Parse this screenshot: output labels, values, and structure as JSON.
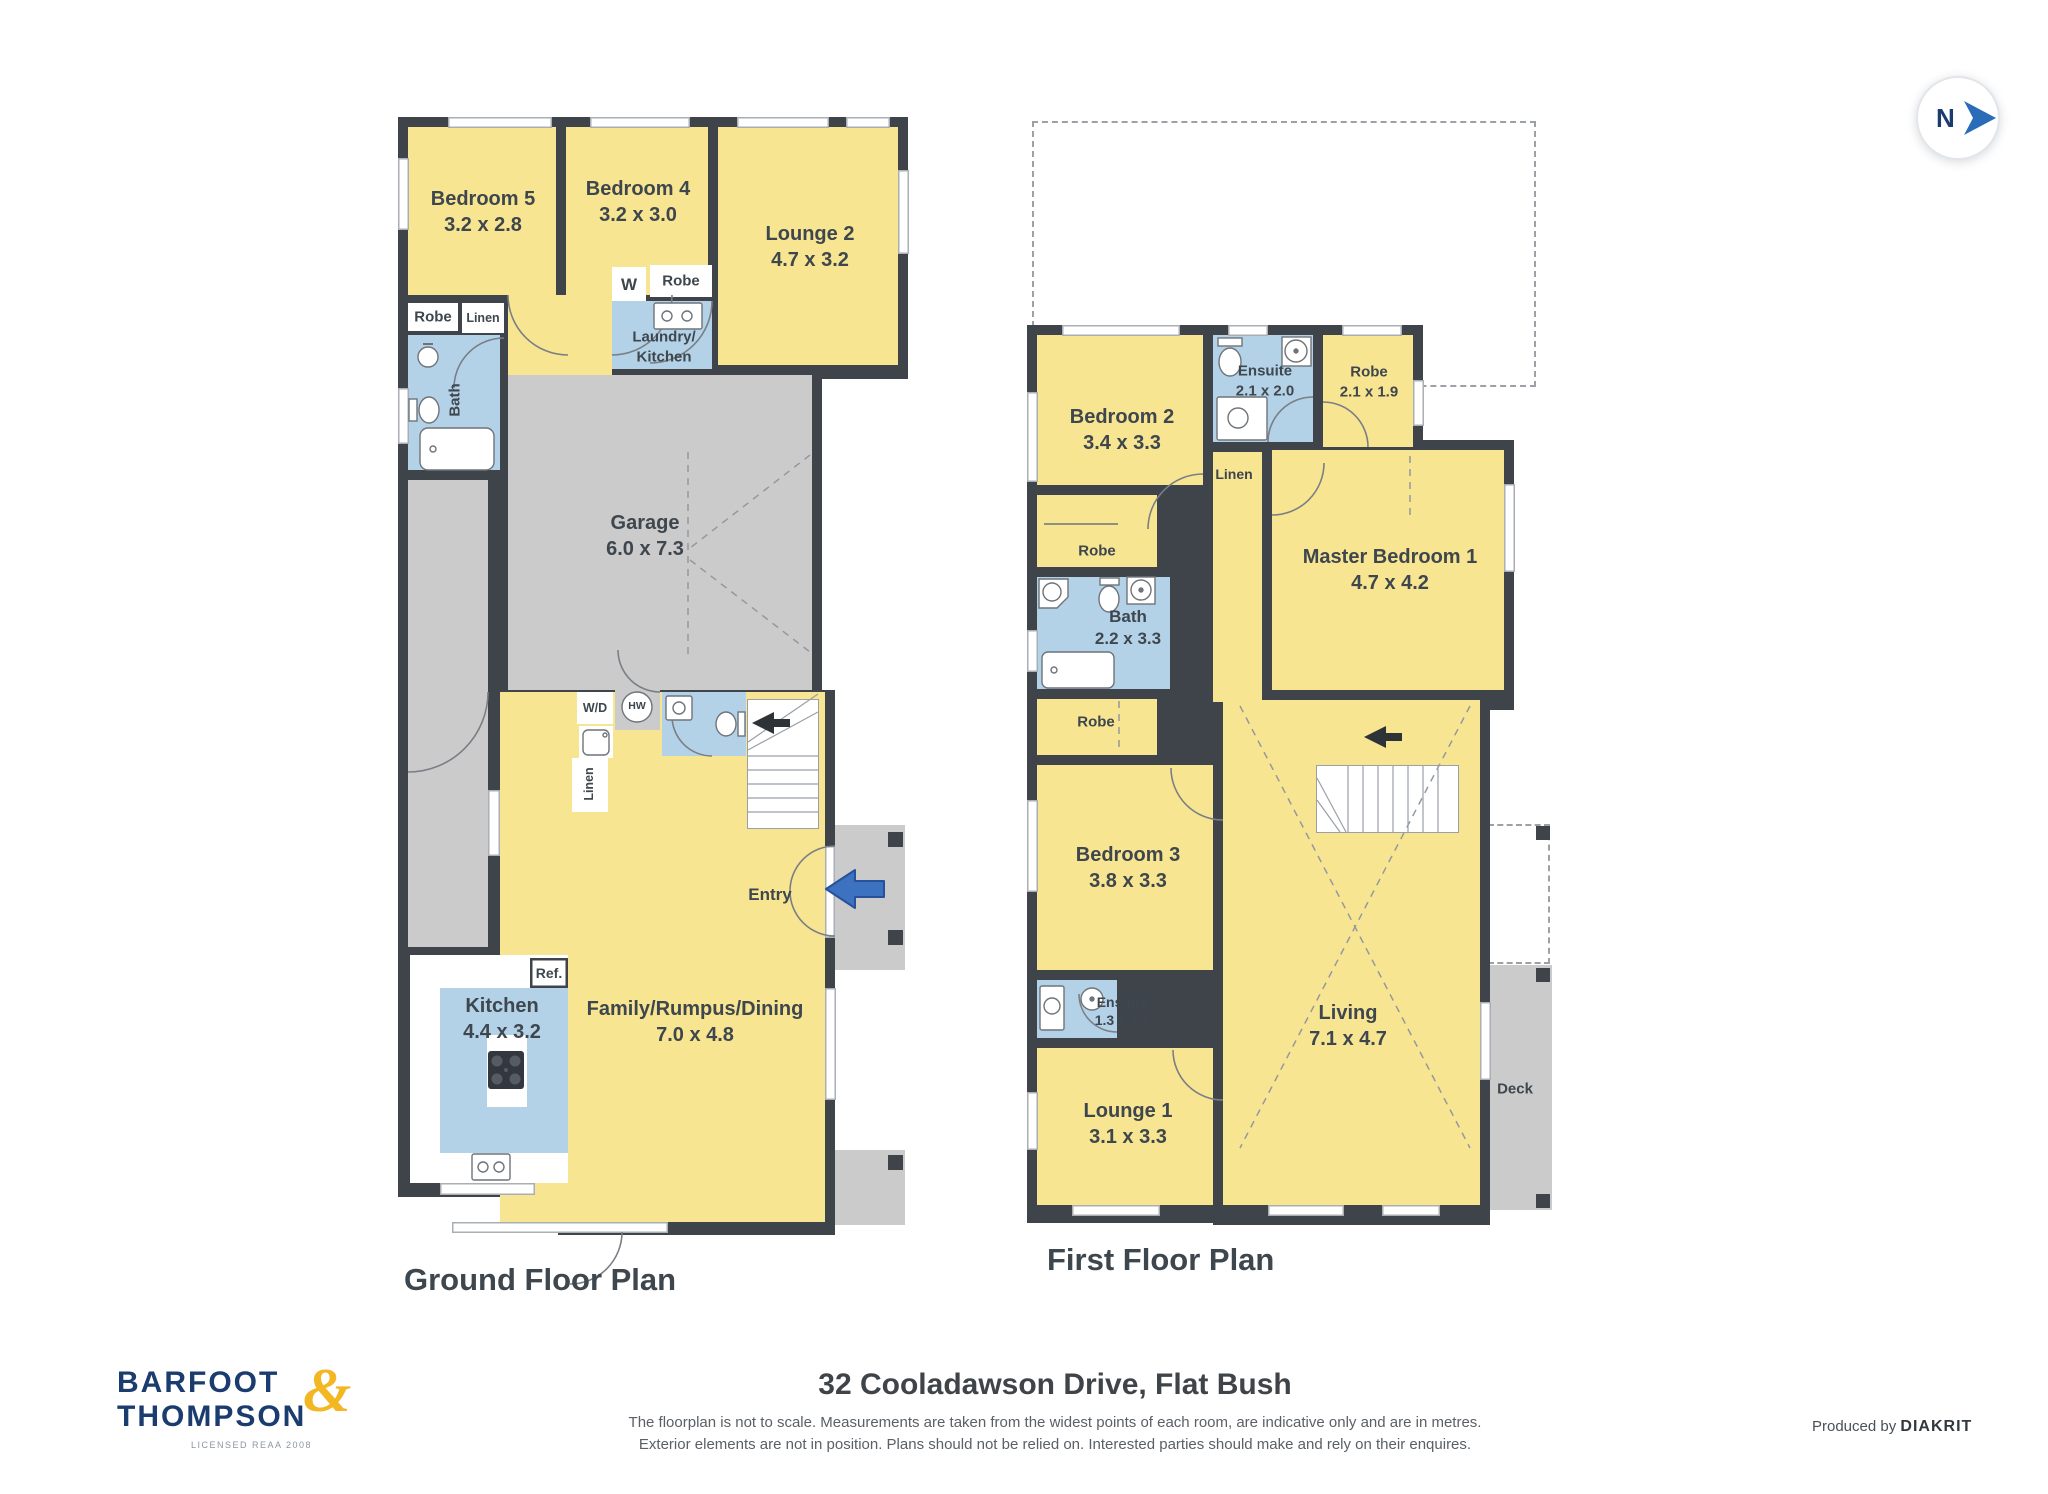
{
  "compass": {
    "n": "N"
  },
  "ground": {
    "title": "Ground Floor Plan",
    "rooms": {
      "bedroom5": {
        "name": "Bedroom 5",
        "dims": "3.2 x 2.8"
      },
      "bedroom4": {
        "name": "Bedroom 4",
        "dims": "3.2 x 3.0"
      },
      "lounge2": {
        "name": "Lounge 2",
        "dims": "4.7 x 3.2"
      },
      "robe1": {
        "name": "Robe"
      },
      "linen1": {
        "name": "Linen"
      },
      "bath": {
        "name": "Bath"
      },
      "w": {
        "name": "W"
      },
      "robe2": {
        "name": "Robe"
      },
      "laundry_line1": "Laundry/",
      "laundry_line2": "Kitchen",
      "garage": {
        "name": "Garage",
        "dims": "6.0 x 7.3"
      },
      "wd": {
        "name": "W/D"
      },
      "hw": {
        "name": "HW"
      },
      "linen2": {
        "name": "Linen"
      },
      "entry": {
        "name": "Entry"
      },
      "kitchen": {
        "name": "Kitchen",
        "dims": "4.4 x 3.2"
      },
      "ref": {
        "name": "Ref."
      },
      "family": {
        "name": "Family/Rumpus/Dining",
        "dims": "7.0 x 4.8"
      }
    }
  },
  "first": {
    "title": "First Floor Plan",
    "rooms": {
      "bedroom2": {
        "name": "Bedroom 2",
        "dims": "3.4 x 3.3"
      },
      "ensuite1": {
        "name": "Ensuite",
        "dims": "2.1 x 2.0"
      },
      "robe1": {
        "name": "Robe",
        "dims": "2.1 x 1.9"
      },
      "linen": {
        "name": "Linen"
      },
      "master": {
        "name": "Master Bedroom 1",
        "dims": "4.7 x 4.2"
      },
      "robe2": {
        "name": "Robe"
      },
      "bath": {
        "name": "Bath",
        "dims": "2.2 x 3.3"
      },
      "robe3": {
        "name": "Robe"
      },
      "bedroom3": {
        "name": "Bedroom 3",
        "dims": "3.8 x 3.3"
      },
      "ensuite2": {
        "name": "Ensuite",
        "dims": "1.3 x 2.1"
      },
      "lounge1": {
        "name": "Lounge 1",
        "dims": "3.1 x 3.3"
      },
      "living": {
        "name": "Living",
        "dims": "7.1 x 4.7"
      },
      "deck": {
        "name": "Deck"
      }
    }
  },
  "footer": {
    "logo": {
      "line1": "BARFOOT",
      "amp": "&",
      "line2": "THOMPSON",
      "tagline": "LICENSED REAA 2008"
    },
    "address": "32 Cooladawson Drive, Flat Bush",
    "disclaimer1": "The floorplan is not to scale. Measurements are taken from the widest points of each room, are indicative only and are in metres.",
    "disclaimer2": "Exterior elements are not in position. Plans should not be relied on. Interested parties should make and rely on their enquires.",
    "produced_by": "Produced by",
    "producer": "DIAKRIT"
  },
  "colors": {
    "room_yellow": "#F8E591",
    "wet_blue": "#B4D2E7",
    "hard_gray": "#CBCBCB",
    "wall": "#3F444B",
    "accent_blue": "#2B6CB8",
    "logo_navy": "#1B3C6E",
    "logo_gold": "#F2B722"
  }
}
